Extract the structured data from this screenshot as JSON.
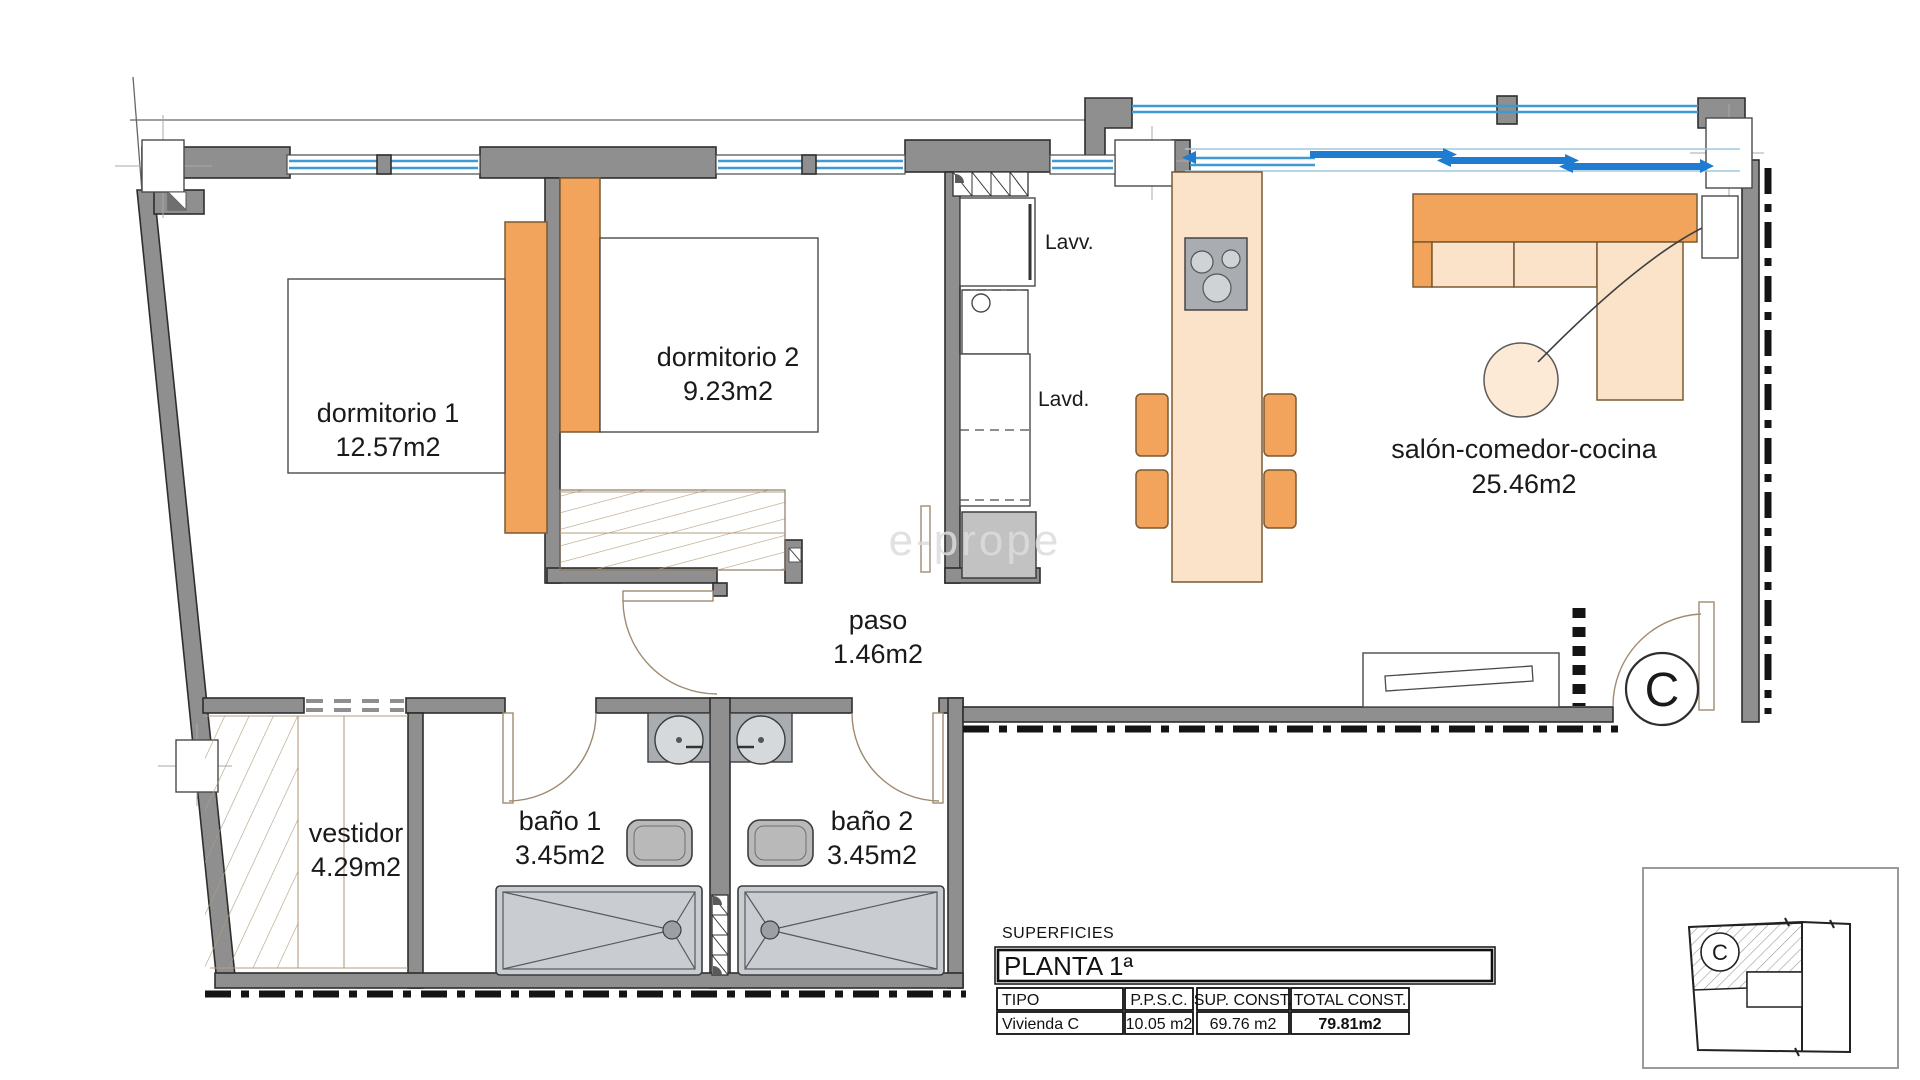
{
  "title": "Floor plan Vivienda C - Planta 1a",
  "colors": {
    "wall": "#8f8f8f",
    "outline": "#2e2e2e",
    "window_blue": "#3f9ad2",
    "slider_blue": "#1f7cd0",
    "peach": "#fbe3c9",
    "orange": "#f3a45c",
    "fixture_gray": "#c9cdd1",
    "fixture_dark": "#a9adb2",
    "hatch_tan": "#b39d82",
    "door_tan": "#a08b72",
    "label": "#1a1a1a",
    "dash": "#141414",
    "watermark": "#d9d9d9",
    "table_border": "#101010"
  },
  "rooms": [
    {
      "name": "dormitorio 1",
      "area": "12.57m2"
    },
    {
      "name": "dormitorio 2",
      "area": "9.23m2"
    },
    {
      "name": "salón-comedor-cocina",
      "area": "25.46m2"
    },
    {
      "name": "paso",
      "area": "1.46m2"
    },
    {
      "name": "vestidor",
      "area": "4.29m2"
    },
    {
      "name": "baño 1",
      "area": "3.45m2"
    },
    {
      "name": "baño 2",
      "area": "3.45m2"
    }
  ],
  "fixture_labels": {
    "lavv": "Lavv.",
    "lavd": "Lavd."
  },
  "entrance": {
    "marker": "C"
  },
  "key_plan": {
    "marker": "C"
  },
  "watermark": {
    "text": "e-prope"
  },
  "table": {
    "title": "SUPERFICIES",
    "floor_header": "PLANTA 1ª",
    "columns": [
      "TIPO",
      "P.P.S.C.",
      "SUP. CONST.",
      "TOTAL CONST."
    ],
    "rows": [
      {
        "tipo": "Vivienda C",
        "ppsc": "10.05 m2",
        "sup_const": "69.76 m2",
        "total_const": "79.81m2"
      }
    ]
  }
}
